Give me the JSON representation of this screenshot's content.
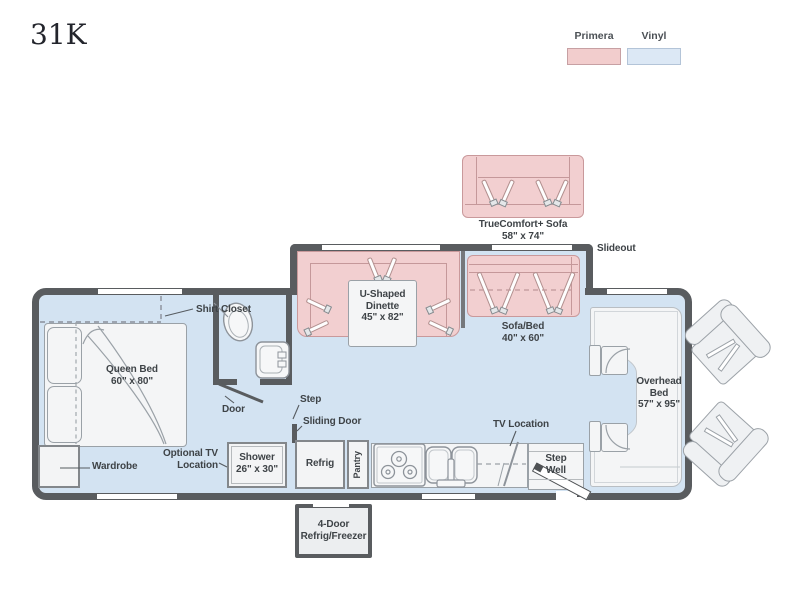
{
  "page": {
    "title": "31K"
  },
  "legend": {
    "items": [
      {
        "label": "Primera",
        "color": "#f2cdcd"
      },
      {
        "label": "Vinyl",
        "color": "#dce8f5"
      }
    ]
  },
  "colors": {
    "wall": "#595c5f",
    "floor": "#d3e3f2",
    "primera_fill": "#f2cfd0",
    "primera_border": "#c9999b",
    "furniture_fill": "#f4f5f6",
    "furniture_border": "#9aa1a7",
    "label_text": "#3e4347"
  },
  "floorplan": {
    "slideout": "Slideout",
    "truecomfort": {
      "name": "TrueComfort+ Sofa",
      "size": "58\" x 74\""
    },
    "dinette": {
      "line1": "U-Shaped",
      "line2": "Dinette",
      "size": "45\" x 82\""
    },
    "sofa_bed": {
      "name": "Sofa/Bed",
      "size": "40\" x 60\""
    },
    "shirt_closet": "Shirt Closet",
    "queen_bed": {
      "name": "Queen Bed",
      "size": "60\" x 80\""
    },
    "wardrobe": "Wardrobe",
    "optional_tv": {
      "line1": "Optional TV",
      "line2": "Location"
    },
    "door": "Door",
    "step": "Step",
    "sliding_door": "Sliding Door",
    "shower": {
      "name": "Shower",
      "size": "26\" x 30\""
    },
    "refrig": "Refrig",
    "pantry": "Pantry",
    "tv_location": "TV Location",
    "step_well": {
      "line1": "Step",
      "line2": "Well"
    },
    "overhead_bed": {
      "line1": "Overhead",
      "line2": "Bed",
      "size": "57\" x 95\""
    },
    "four_door": {
      "line1": "4-Door",
      "line2": "Refrig/Freezer"
    }
  }
}
